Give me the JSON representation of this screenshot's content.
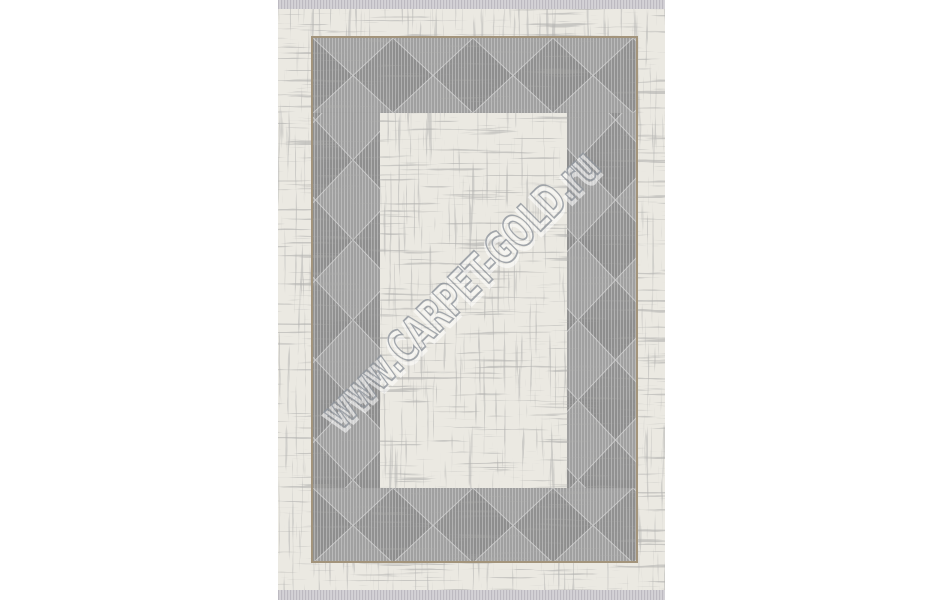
{
  "image": {
    "type": "product-photo",
    "subject": "rectangular area rug, cream field with distressed texture and grey geometric triangle border band",
    "orientation": "vertical, fringe at top and bottom edges"
  },
  "watermark": {
    "text": "www.CARPET-GOLD.ru",
    "angle_deg": -45,
    "style": "embossed outline, semi-transparent"
  },
  "colors": {
    "page_background": "#ffffff",
    "rug_cream": "#ebe9e2",
    "band_gray": "#a0a0a0",
    "band_gray_dark": "#8e8e8e",
    "band_edge_light": "#c9c9c9",
    "pinstripe": "#dadada",
    "gold_trim": "#a3947b",
    "fringe_base": "#d7d5d9",
    "fringe_stripe": "#bdbac1",
    "distress_mark": "#706f6d",
    "watermark_outline": "#8f959d",
    "watermark_highlight": "#ffffff"
  }
}
